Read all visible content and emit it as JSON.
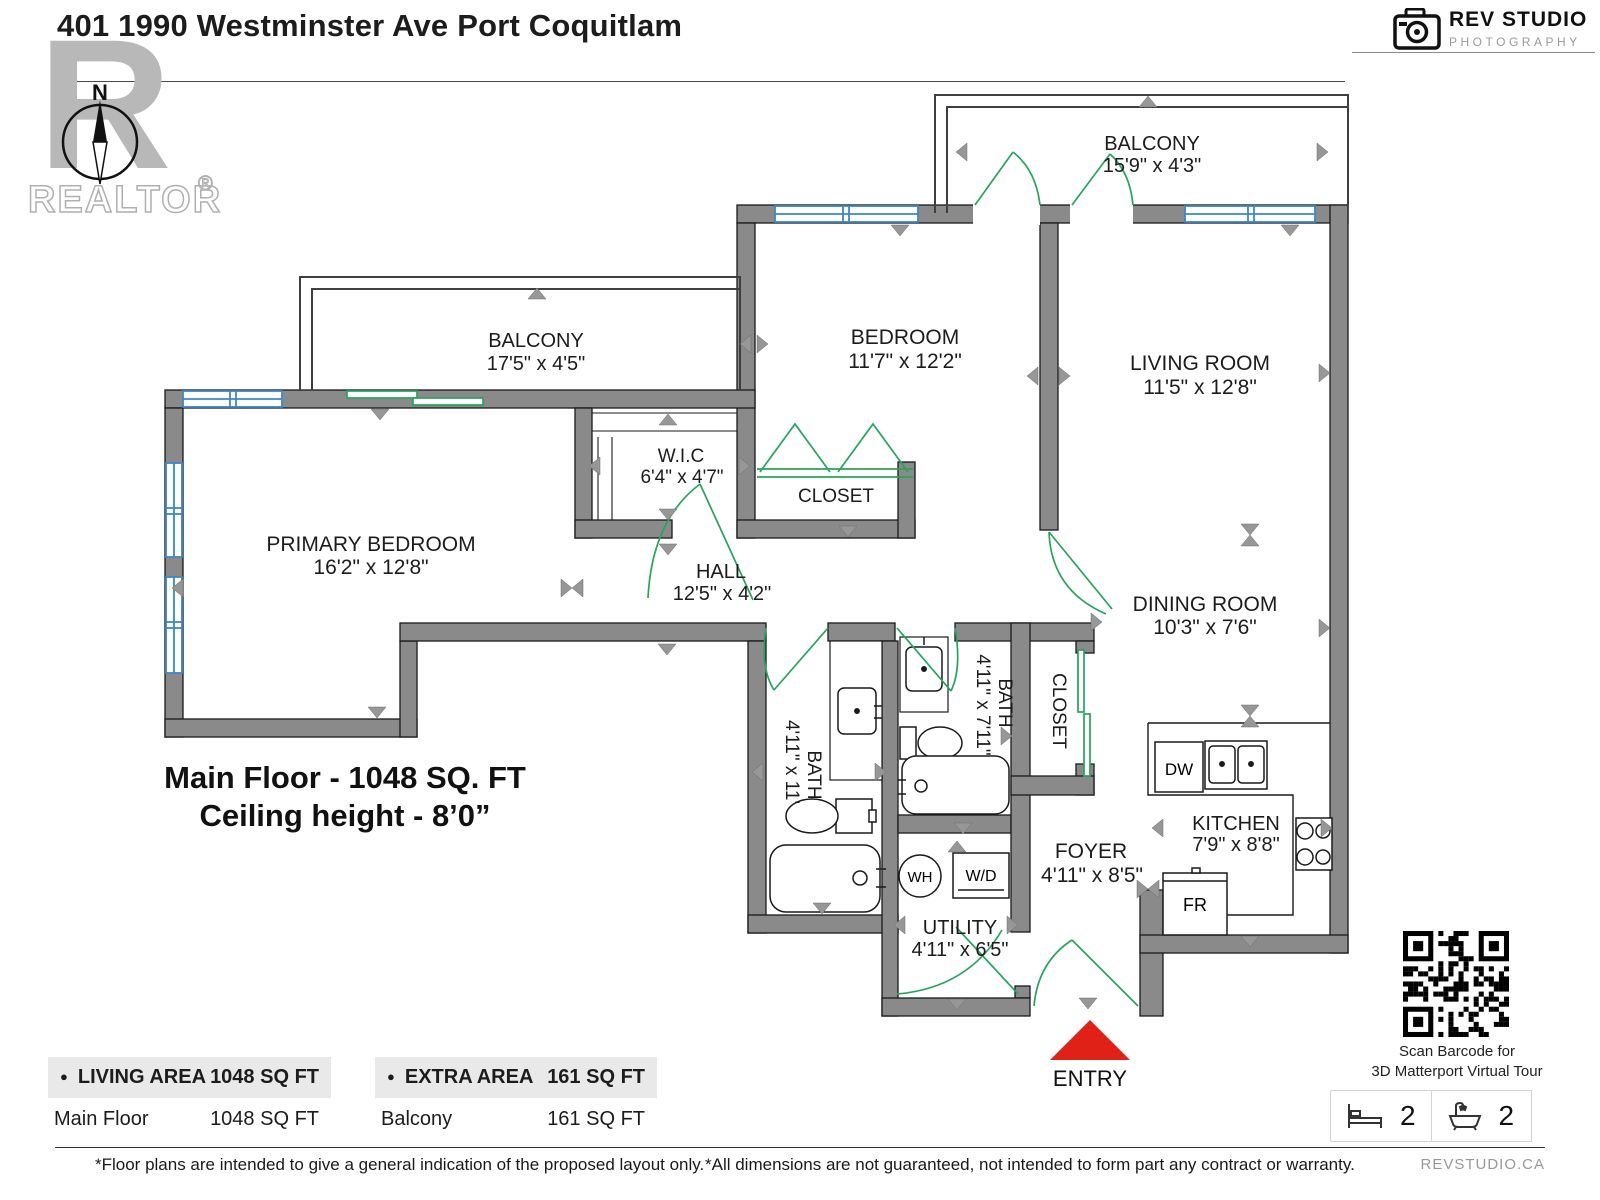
{
  "header": {
    "title": "401 1990 Westminster Ave Port Coquitlam",
    "brand": {
      "name": "REV STUDIO",
      "sub": "PHOTOGRAPHY"
    },
    "realtor": {
      "label": "REALTOR",
      "reg": "®",
      "north": "N"
    }
  },
  "floor_summary": {
    "line1": "Main Floor - 1048 SQ. FT",
    "line2": "Ceiling height - 8’0”"
  },
  "rooms": {
    "balcony_top": {
      "name": "BALCONY",
      "dims": "15'9\" x 4'3\""
    },
    "balcony_left": {
      "name": "BALCONY",
      "dims": "17'5\" x 4'5\""
    },
    "bedroom": {
      "name": "BEDROOM",
      "dims": "11'7\" x 12'2\""
    },
    "living": {
      "name": "LIVING ROOM",
      "dims": "11'5\" x 12'8\""
    },
    "primary": {
      "name": "PRIMARY BEDROOM",
      "dims": "16'2\" x 12'8\""
    },
    "wic": {
      "name": "W.I.C",
      "dims": "6'4\" x 4'7\""
    },
    "closet_bedroom": {
      "name": "CLOSET"
    },
    "hall": {
      "name": "HALL",
      "dims": "12'5\" x 4'2\""
    },
    "dining": {
      "name": "DINING ROOM",
      "dims": "10'3\" x 7'6\""
    },
    "bath1": {
      "name": "BATH",
      "dims": "4'11\" x 11'"
    },
    "bath2": {
      "name": "BATH",
      "dims": "4'11\" x 7'11\""
    },
    "closet_foyer": {
      "name": "CLOSET"
    },
    "kitchen": {
      "name": "KITCHEN",
      "dims": "7'9\" x 8'8\""
    },
    "foyer": {
      "name": "FOYER",
      "dims": "4'11\" x 8'5\""
    },
    "utility": {
      "name": "UTILITY",
      "dims": "4'11\" x 6'5\""
    },
    "entry": {
      "name": "ENTRY"
    }
  },
  "fixtures": {
    "dw": "DW",
    "fr": "FR",
    "wh": "WH",
    "wd": "W/D"
  },
  "area_tables": [
    {
      "bullet": "●",
      "header": "LIVING AREA",
      "header_value": "1048 SQ FT",
      "rows": [
        {
          "label": "Main Floor",
          "value": "1048 SQ FT"
        }
      ]
    },
    {
      "bullet": "●",
      "header": "EXTRA AREA",
      "header_value": "161 SQ FT",
      "rows": [
        {
          "label": "Balcony",
          "value": "161 SQ FT"
        }
      ]
    }
  ],
  "qr": {
    "caption_line1": "Scan Barcode for",
    "caption_line2": "3D Matterport Virtual Tour"
  },
  "stats": {
    "beds": "2",
    "baths": "2"
  },
  "footer": {
    "left": "*Floor plans are intended to give a general indication of the proposed layout only.",
    "right": "*All dimensions are not guaranteed, not intended to form part any contract or warranty.",
    "brand": "REVSTUDIO.CA"
  },
  "colors": {
    "wall": "#8a8a8a",
    "window": "#3b87c8",
    "door": "#27a35d",
    "entry": "#e02117",
    "arrow": "#979797"
  }
}
